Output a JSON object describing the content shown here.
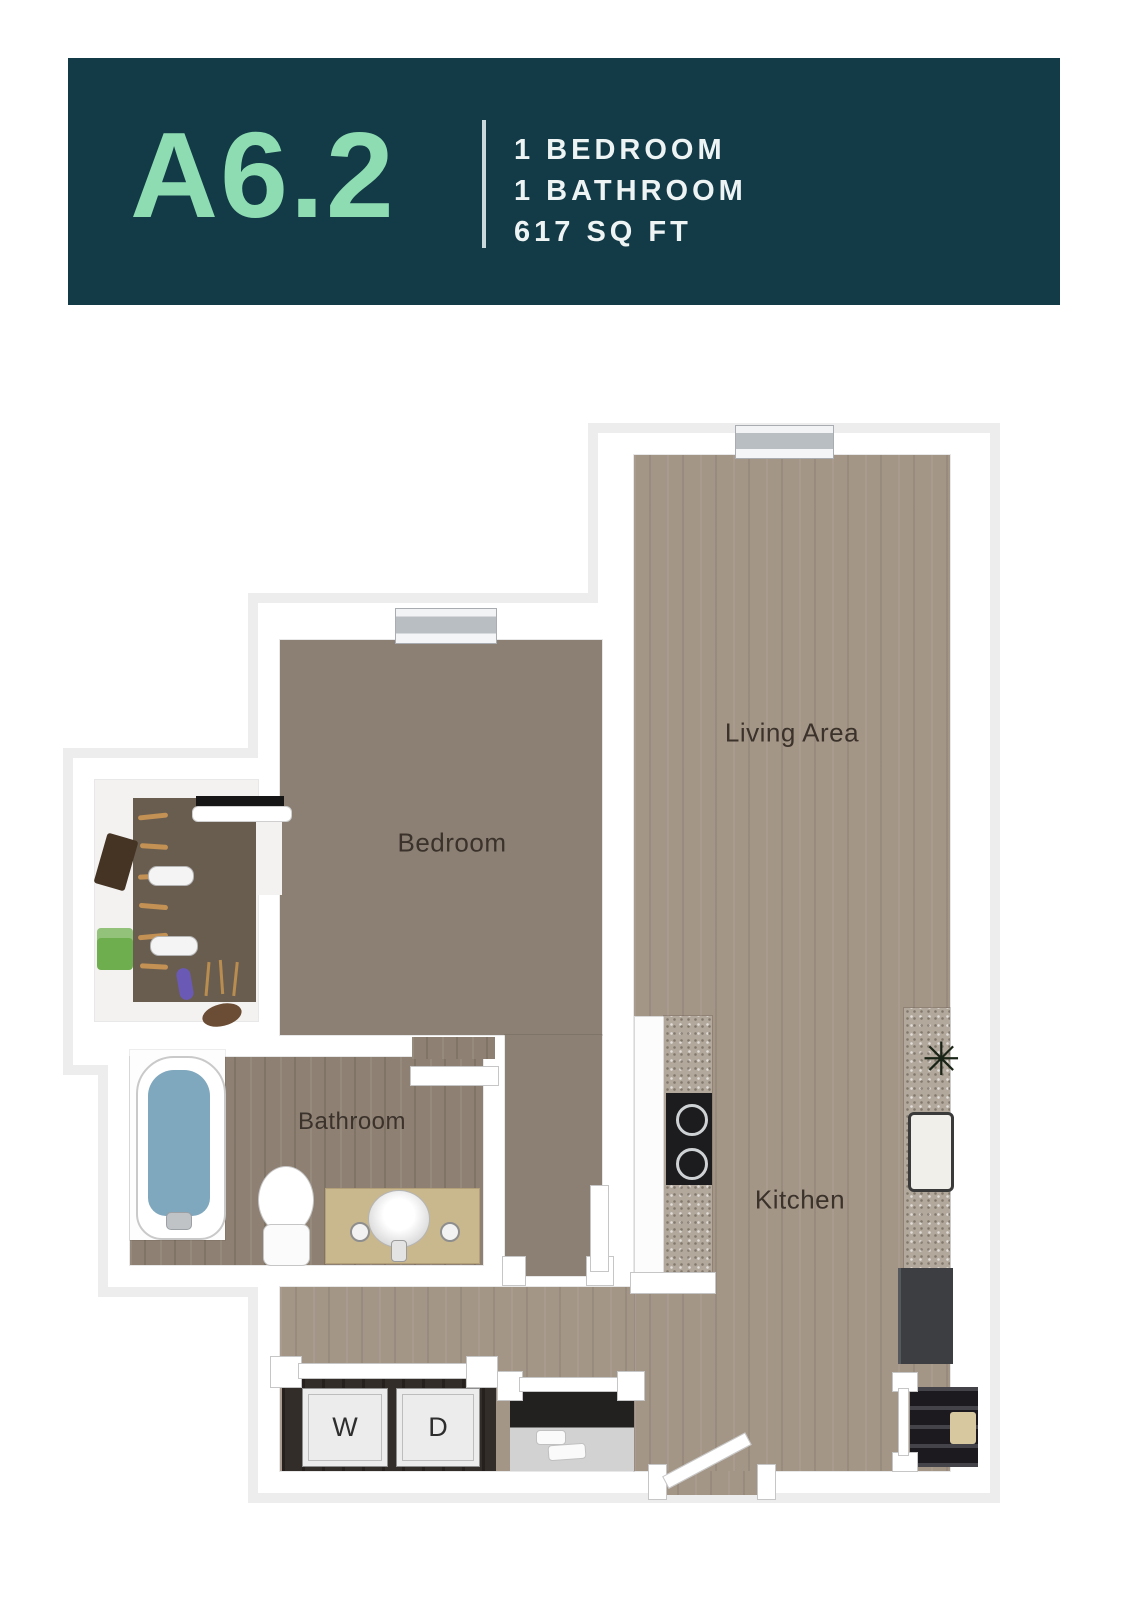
{
  "header": {
    "plan_name": "A6.2",
    "details": [
      "1 BEDROOM",
      "1 BATHROOM",
      "617 SQ FT"
    ]
  },
  "floor_plan": {
    "rooms": {
      "living": {
        "label": "Living Area"
      },
      "bedroom": {
        "label": "Bedroom"
      },
      "bathroom": {
        "label": "Bathroom"
      },
      "kitchen": {
        "label": "Kitchen"
      }
    },
    "appliances": {
      "washer": {
        "label": "W"
      },
      "dryer": {
        "label": "D"
      }
    },
    "icons": {
      "plant": "✳"
    }
  },
  "colors": {
    "header_bg": "#123b47",
    "plan_name": "#8edcb2",
    "header_text": "#eef3f4",
    "divider": "#c9d8da",
    "wall": "#ffffff",
    "halo": "#ededed",
    "wood": "#a49687",
    "bathwood": "#8e8173",
    "carpet": "#8b8073",
    "granite": "#b2a89c",
    "label": "#3b322b"
  }
}
